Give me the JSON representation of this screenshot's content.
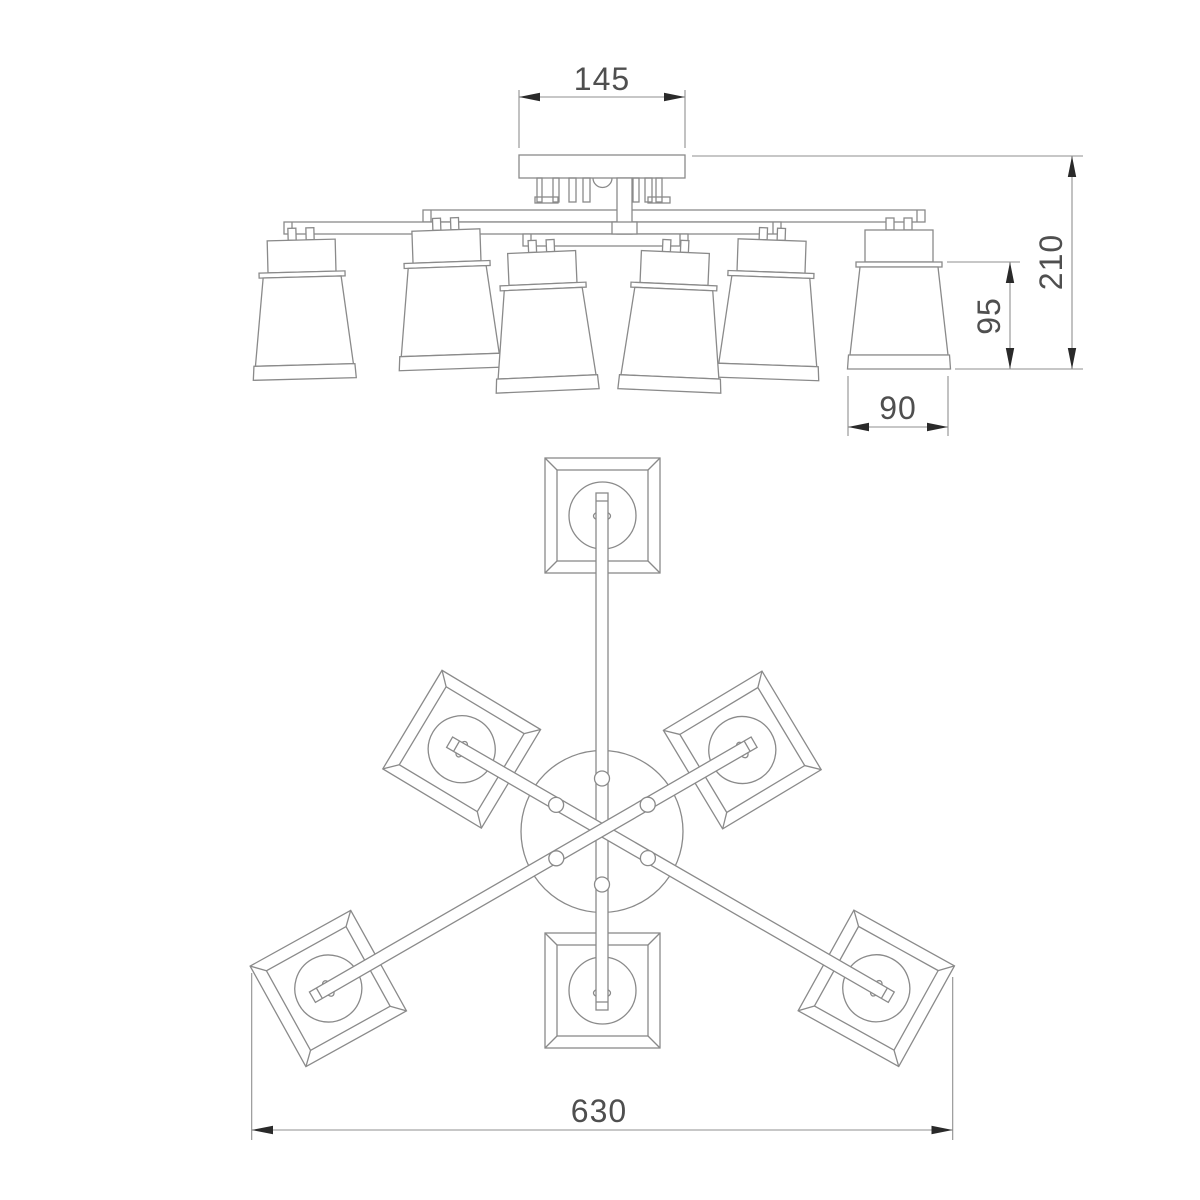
{
  "dims": {
    "canopy_width": "145",
    "fixture_height": "210",
    "shade_height": "95",
    "shade_width": "90",
    "overall_diameter": "630"
  },
  "front_view": {
    "lampshade_count": 6
  },
  "plan_view": {
    "lampshade_count": 6
  },
  "colors": {
    "background": "#ffffff",
    "line": "#8a8a8a",
    "dim_text": "#4f4f4f",
    "arrow": "#2a2a2a"
  }
}
